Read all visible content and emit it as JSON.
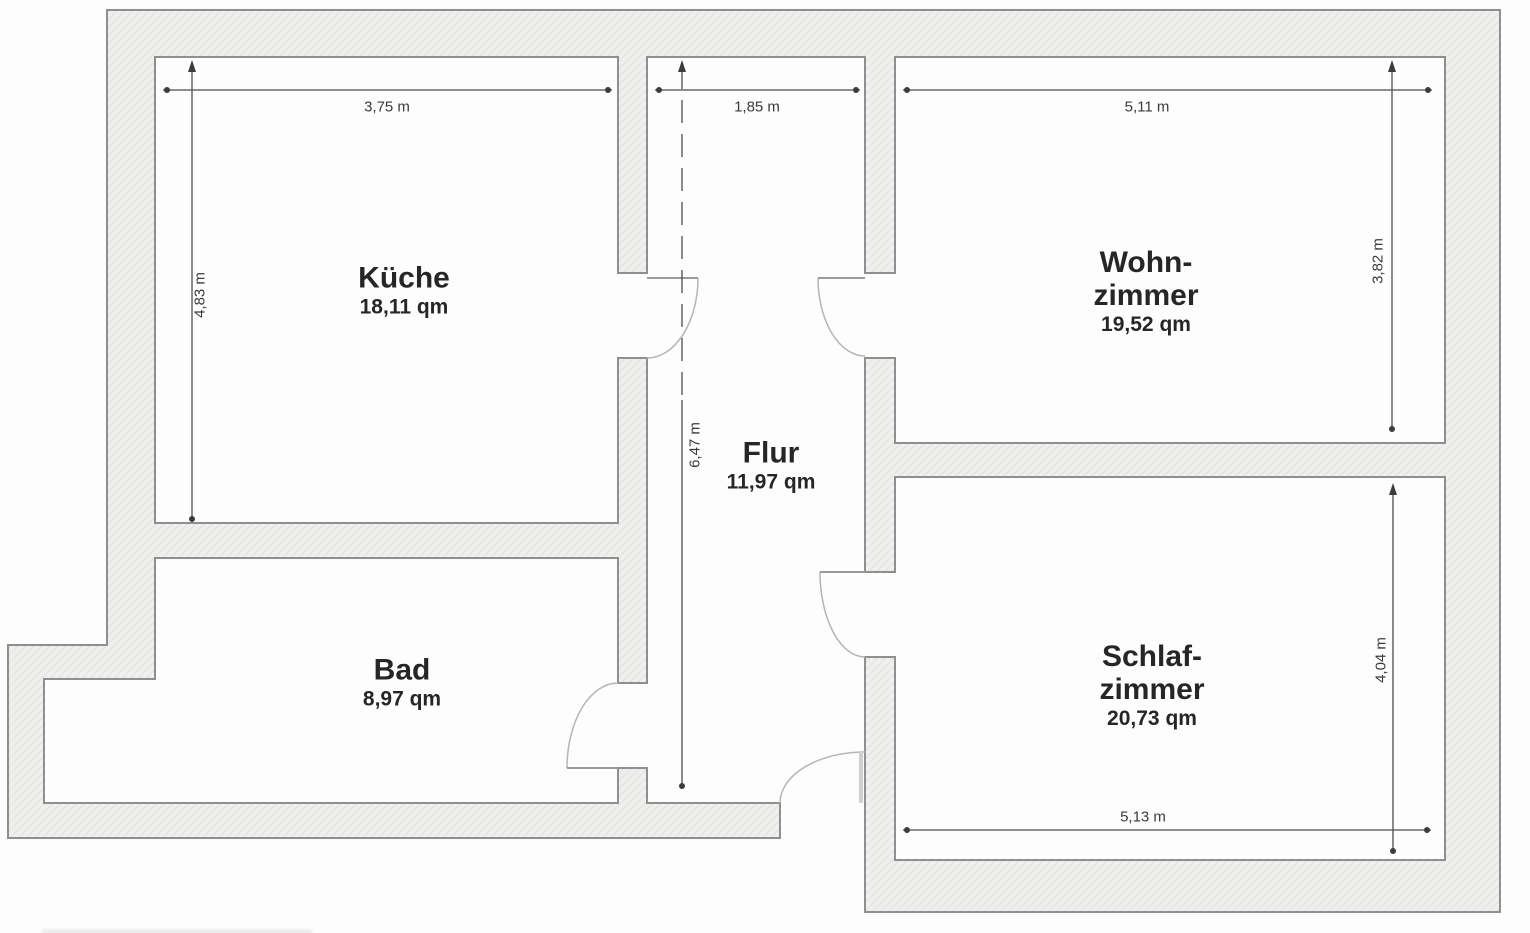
{
  "plan": {
    "rooms": {
      "kueche": {
        "name": "Küche",
        "area": "18,11 qm",
        "width": "3,75 m",
        "height": "4,83 m"
      },
      "flur": {
        "name": "Flur",
        "area": "11,97 qm",
        "width": "1,85 m",
        "height": "6,47 m"
      },
      "wohnzimmer": {
        "name_line1": "Wohn-",
        "name_line2": "zimmer",
        "area": "19,52 qm",
        "width": "5,11 m",
        "height": "3,82 m"
      },
      "bad": {
        "name": "Bad",
        "area": "8,97 qm"
      },
      "schlafzimmer": {
        "name_line1": "Schlaf-",
        "name_line2": "zimmer",
        "area": "20,73 qm",
        "width": "5,13 m",
        "height": "4,04 m"
      }
    },
    "colors": {
      "wall_fill": "#f0f0ef",
      "wall_outline": "#8f8f8f",
      "dimension_line": "#4d4d4d",
      "door_arc": "#b5b5b5",
      "text": "#262626"
    }
  }
}
